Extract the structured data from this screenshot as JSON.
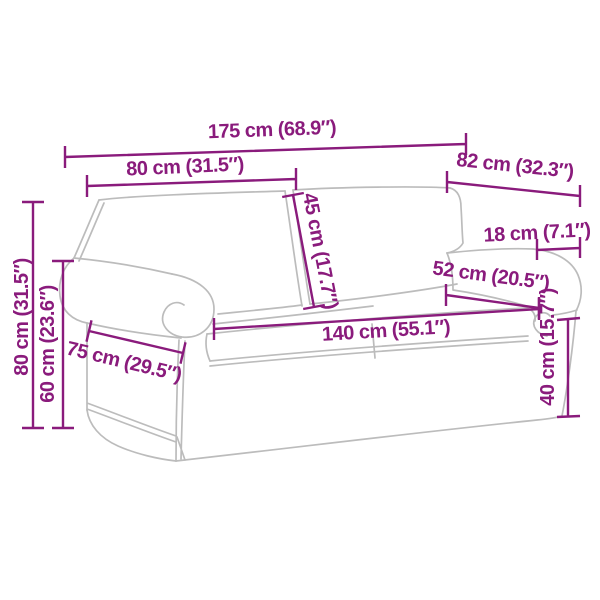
{
  "diagram": {
    "title": "Sofa dimension diagram",
    "subject": "2-seater rolled-arm sofa line drawing with measurements",
    "style": {
      "dimension_color": "#8a1b7c",
      "outline_color": "#bcbcbc",
      "background_color": "#ffffff"
    },
    "dims": {
      "total_width": "175 cm (68.9″)",
      "backrest_width": "80 cm (31.5″)",
      "depth": "82 cm (32.3″)",
      "back_cushion_height": "45 cm (17.7″)",
      "armrest_width": "18 cm (7.1″)",
      "seat_depth": "52 cm (20.5″)",
      "seat_width": "140 cm (55.1″)",
      "armrest_depth": "75 cm (29.5″)",
      "total_height": "80 cm (31.5″)",
      "armrest_height": "60 cm (23.6″)",
      "seat_height": "40 cm (15.7″)"
    }
  }
}
